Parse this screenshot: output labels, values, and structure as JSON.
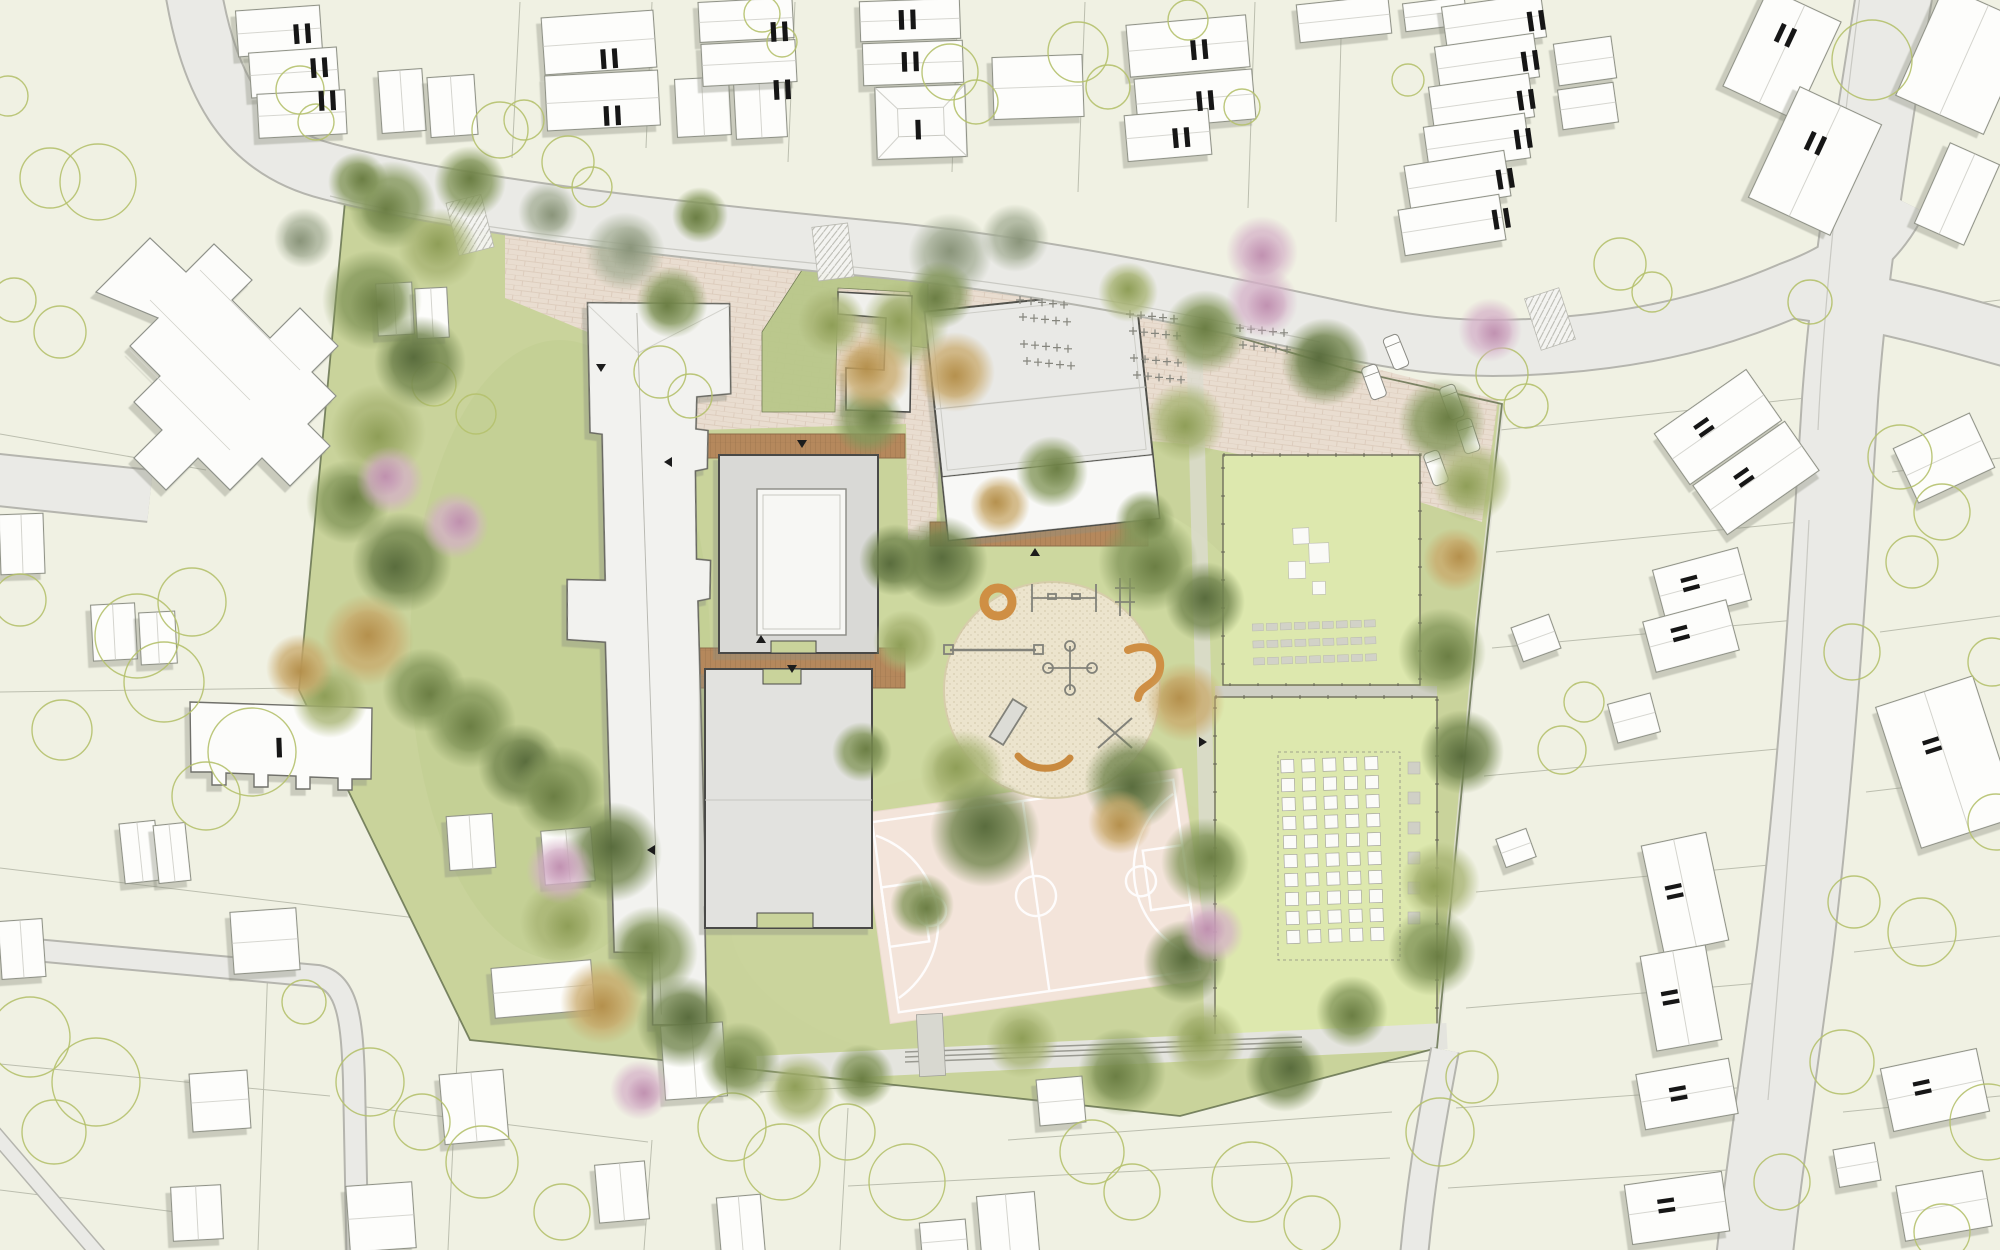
{
  "plan": {
    "kind": "landscape-architecture-site-plan",
    "storey_labels": [
      {
        "text": "II",
        "x": 303,
        "y": 34,
        "rot": -4
      },
      {
        "text": "II",
        "x": 320,
        "y": 68,
        "rot": -4
      },
      {
        "text": "II",
        "x": 328,
        "y": 101,
        "rot": -3
      },
      {
        "text": "II",
        "x": 610,
        "y": 59,
        "rot": -4
      },
      {
        "text": "II",
        "x": 613,
        "y": 116,
        "rot": -3
      },
      {
        "text": "II",
        "x": 780,
        "y": 32,
        "rot": -3
      },
      {
        "text": "II",
        "x": 783,
        "y": 90,
        "rot": -3
      },
      {
        "text": "II",
        "x": 908,
        "y": 20,
        "rot": -2
      },
      {
        "text": "II",
        "x": 911,
        "y": 62,
        "rot": -2
      },
      {
        "text": "I",
        "x": 919,
        "y": 130,
        "rot": -2
      },
      {
        "text": "II",
        "x": 1200,
        "y": 50,
        "rot": -5
      },
      {
        "text": "II",
        "x": 1206,
        "y": 101,
        "rot": -5
      },
      {
        "text": "II",
        "x": 1182,
        "y": 138,
        "rot": -5
      },
      {
        "text": "II",
        "x": 1537,
        "y": 21,
        "rot": -8
      },
      {
        "text": "II",
        "x": 1531,
        "y": 61,
        "rot": -8
      },
      {
        "text": "II",
        "x": 1527,
        "y": 100,
        "rot": -8
      },
      {
        "text": "II",
        "x": 1524,
        "y": 139,
        "rot": -8
      },
      {
        "text": "II",
        "x": 1506,
        "y": 179,
        "rot": -9
      },
      {
        "text": "II",
        "x": 1502,
        "y": 219,
        "rot": -9
      },
      {
        "text": "II",
        "x": 1786,
        "y": 36,
        "rot": 25
      },
      {
        "text": "II",
        "x": 1816,
        "y": 144,
        "rot": 25
      },
      {
        "text": "II",
        "x": 1704,
        "y": 428,
        "rot": 55
      },
      {
        "text": "II",
        "x": 1744,
        "y": 478,
        "rot": 55
      },
      {
        "text": "II",
        "x": 1690,
        "y": 584,
        "rot": 75
      },
      {
        "text": "II",
        "x": 1680,
        "y": 634,
        "rot": 75
      },
      {
        "text": "II",
        "x": 1932,
        "y": 746,
        "rot": 72
      },
      {
        "text": "II",
        "x": 1674,
        "y": 892,
        "rot": 78
      },
      {
        "text": "II",
        "x": 1670,
        "y": 998,
        "rot": 80
      },
      {
        "text": "II",
        "x": 1678,
        "y": 1094,
        "rot": 80
      },
      {
        "text": "II",
        "x": 1922,
        "y": 1088,
        "rot": 78
      },
      {
        "text": "II",
        "x": 1666,
        "y": 1206,
        "rot": 82
      },
      {
        "text": "I",
        "x": 280,
        "y": 748,
        "rot": -2
      }
    ],
    "features": [
      "site-boundary",
      "entrance-plaza-paving",
      "school-building-long",
      "classroom-building-with-courtyard",
      "classroom-building",
      "gym-hall",
      "l-shaped-pavilion",
      "central-sand-playground",
      "basketball-court",
      "multi-use-lawn",
      "outdoor-classroom-bench-rows",
      "school-garden-raised-beds",
      "wooden-deck-walkways",
      "bike-racks",
      "car-parking",
      "pedestrian-crossings",
      "residential-houses",
      "community-building",
      "comb-shaped-building",
      "roads",
      "existing-tree-symbols",
      "rendered-tree-canopies",
      "footpath-with-benches"
    ],
    "playground_equipment": [
      "carousel-ring",
      "swing-frame",
      "climbing-frame",
      "balance-beam",
      "spinner-cross",
      "snake-bench",
      "slide",
      "seesaw-cross",
      "crawl-worm"
    ],
    "counts": {
      "basketball_courts": 1,
      "garden_bed_columns": 5,
      "garden_bed_rows": 10,
      "bench_rows": 3,
      "benches_per_row": 9,
      "white_platforms_on_lawn": 4
    },
    "palette": {
      "background": "#f0f1e3",
      "road_fill": "#eaeae6",
      "road_edge": "#b5b5ae",
      "parcel_line": "#b3b6a7",
      "site_green": "#c9d39b",
      "sport_lawn": "#dde8ae",
      "plaza_brick": "#e9ddd0",
      "court_surface": "#f3e4da",
      "court_lines": "#ffffff",
      "playground_sand": "#ece4cd",
      "wood_deck": "#b5885c",
      "building_white": "#f2f2ef",
      "building_grey": "#dedeDC",
      "boundary_line": "#5f6b49",
      "tree_symbol_stroke": "#b5c16d",
      "tree_green": "#7d9055",
      "tree_olive": "#9aa865",
      "tree_autumn": "#c09a58",
      "tree_blossom": "#c99bb8",
      "equipment_orange": "#cf8f44",
      "label_color": "#161616"
    }
  }
}
